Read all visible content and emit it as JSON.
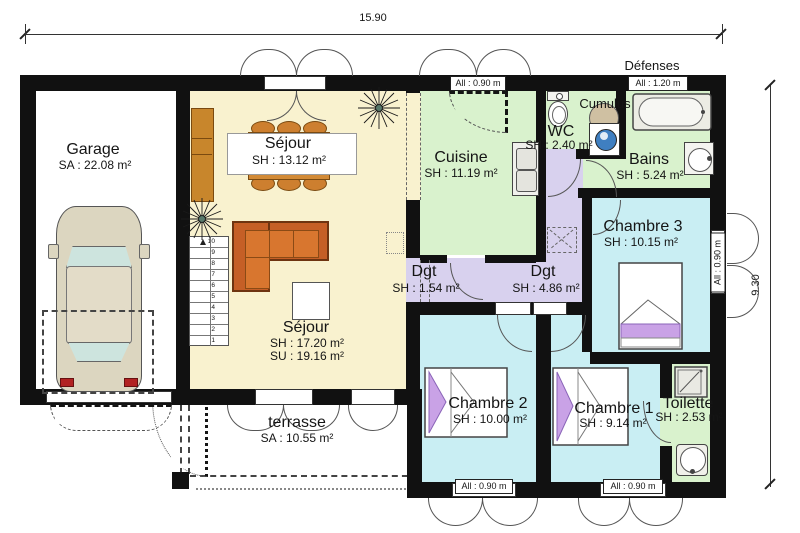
{
  "plan": {
    "dimensions": {
      "width": "15.90",
      "height": "9.30"
    },
    "annotations": {
      "defenses": "Défenses",
      "cumulus": "Cumulus"
    },
    "window_labels": {
      "standard": "All : 0.90 m",
      "wide": "All : 1.20 m"
    },
    "rooms": {
      "garage": {
        "name": "Garage",
        "area": "SA : 22.08 m²"
      },
      "sejour_dining": {
        "name": "Séjour",
        "area": "SH : 13.12 m²"
      },
      "sejour_living": {
        "name": "Séjour",
        "area": "SH : 17.20 m²",
        "area2": "SU : 19.16 m²"
      },
      "cuisine": {
        "name": "Cuisine",
        "area": "SH : 11.19 m²"
      },
      "wc": {
        "name": "WC",
        "area": "SH : 2.40 m²"
      },
      "bains": {
        "name": "Bains",
        "area": "SH : 5.24 m²"
      },
      "chambre3": {
        "name": "Chambre 3",
        "area": "SH : 10.15 m²"
      },
      "dgt_petit": {
        "name": "Dgt",
        "area": "SH : 1.54 m²"
      },
      "dgt_grand": {
        "name": "Dgt",
        "area": "SH : 4.86 m²"
      },
      "chambre2": {
        "name": "Chambre 2",
        "area": "SH : 10.00 m²"
      },
      "chambre1": {
        "name": "Chambre 1",
        "area": "SH : 9.14 m²"
      },
      "toilette": {
        "name": "Toilette",
        "area": "SH : 2.53 m²"
      },
      "terrasse": {
        "name": "terrasse",
        "area": "SA : 10.55 m²"
      }
    },
    "stairs": {
      "numbers": [
        "10",
        "9",
        "8",
        "7",
        "6",
        "5",
        "4",
        "3",
        "2",
        "1"
      ]
    },
    "colors": {
      "wall": "#111111",
      "living": "#f9f2cf",
      "wet_rooms": "#d9f2cd",
      "bedrooms": "#c9eef3",
      "hallway": "#d8d1ee",
      "furniture_orange": "#cc6a28",
      "bed_purple": "#c9a2e6",
      "machine_blue": "#3f7fc1"
    }
  }
}
